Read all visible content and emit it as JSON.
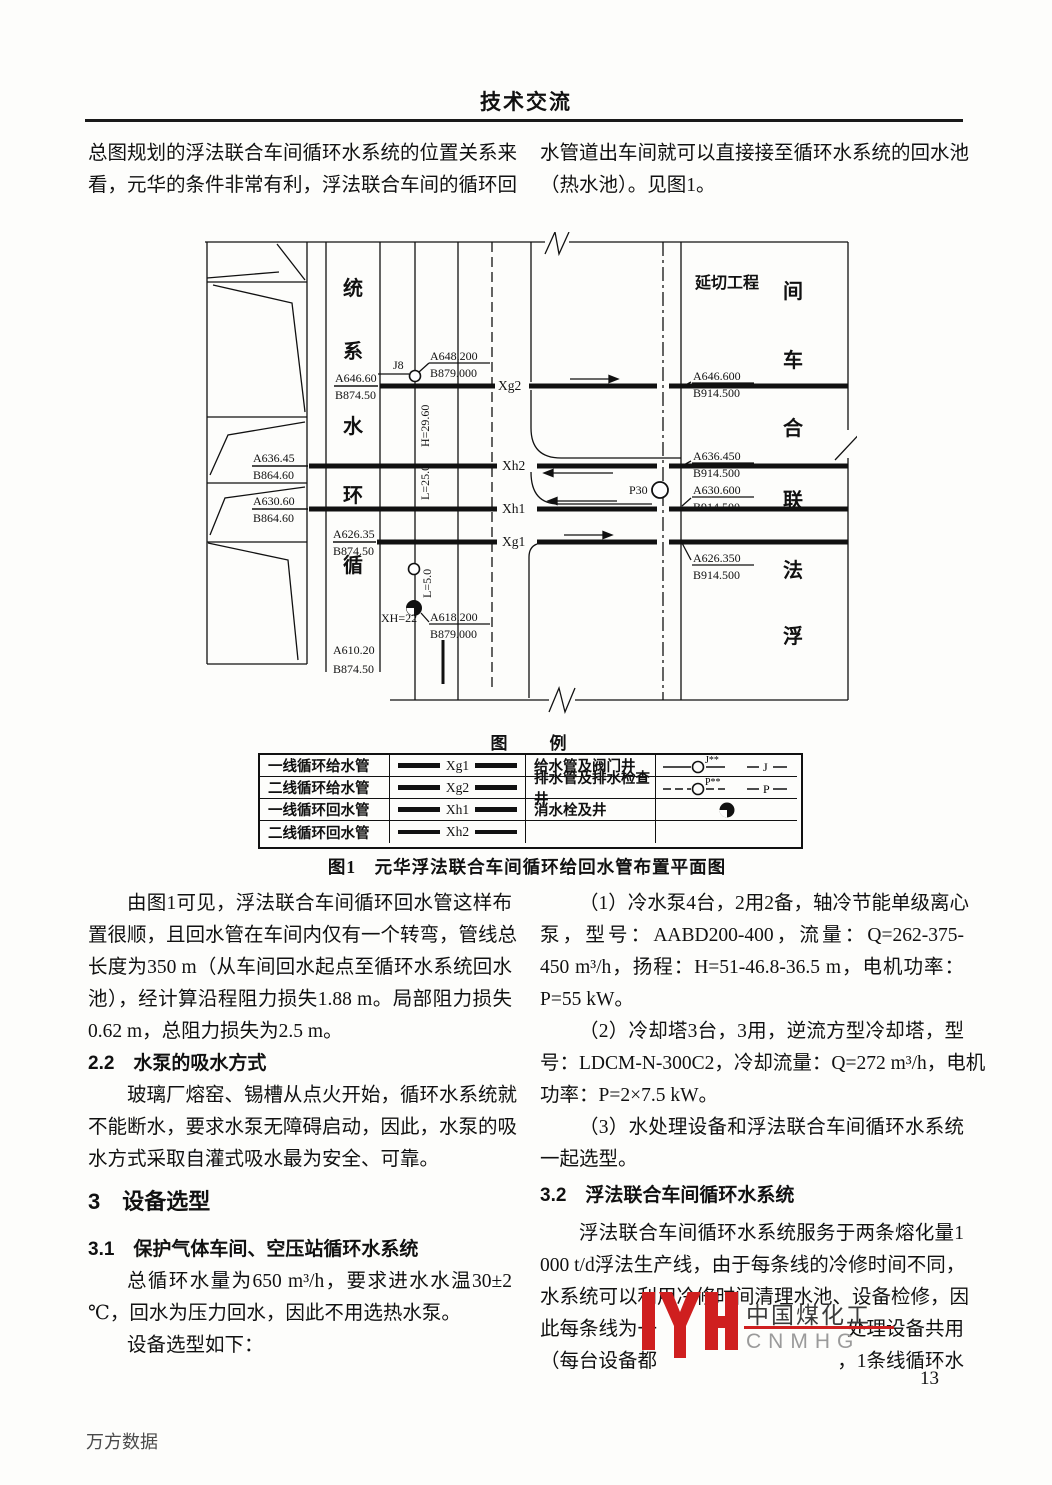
{
  "page": {
    "header": "技术交流",
    "page_number": "13",
    "footer": "万方数据"
  },
  "intro": {
    "left": [
      "总图规划的浮法联合车间循环水系统的位置关系来",
      "看，元华的条件非常有利，浮法联合车间的循环回"
    ],
    "right": [
      "水管道出车间就可以直接接至循环水系统的回水池",
      "（热水池）。见图1。"
    ]
  },
  "figure": {
    "caption": "图1　元华浮法联合车间循环给回水管布置平面图",
    "legend_title": {
      "t1": "图",
      "t2": "例"
    },
    "legend_rows": [
      {
        "name": "一线循环给水管",
        "pipe": "Xg1",
        "right": "给水管及阀门井",
        "sup": "J**",
        "sym": "J"
      },
      {
        "name": "二线循环给水管",
        "pipe": "Xg2",
        "right": "排水管及排水检查井",
        "sup": "P**",
        "sym": "P"
      },
      {
        "name": "一线循环回水管",
        "pipe": "Xh1",
        "right": "消水栓及井"
      },
      {
        "name": "二线循环回水管",
        "pipe": "Xh2",
        "right": ""
      }
    ],
    "diagram": {
      "zone_label": "延切工程",
      "left_axis_chars": [
        "统",
        "系",
        "水",
        "环",
        "循"
      ],
      "right_axis_chars": [
        "间",
        "车",
        "合",
        "联",
        "法",
        "浮"
      ],
      "pipes": {
        "xg2": "Xg2",
        "xh2": "Xh2",
        "xh1": "Xh1",
        "xg1": "Xg1"
      },
      "wells": {
        "j8": "J8",
        "p30": "P30"
      },
      "dims": {
        "h": "H=29.60",
        "l25": "L=25.0",
        "l5": "L=5.0",
        "xh22": "XH=22"
      },
      "elev": {
        "e1a": "A646.60",
        "e1b": "B874.50",
        "e2a": "A636.45",
        "e2b": "B864.60",
        "e3a": "A630.60",
        "e3b": "B864.60",
        "e4a": "A626.35",
        "e4b": "B874.50",
        "e5a": "A610.20",
        "e5b": "B874.50",
        "j8a": "A648.200",
        "j8b": "B879.000",
        "xha": "A618.200",
        "xhb": "B879.000",
        "r1a": "A646.600",
        "r1b": "B914.500",
        "r2a": "A636.450",
        "r2b": "B914.500",
        "r3a": "A630.600",
        "r3b": "B914.500",
        "r4a": "A626.350",
        "r4b": "B914.500"
      }
    }
  },
  "left_column": {
    "lines": [
      "由图1可见，浮法联合车间循环回水管这样布",
      "置很顺，且回水管在车间内仅有一个转弯，管线总",
      "长度为350 m（从车间回水起点至循环水系统回水",
      "池），经计算沿程阻力损失1.88 m。局部阻力损失",
      "0.62 m，总阻力损失为2.5 m。",
      "玻璃厂熔窑、锡槽从点火开始，循环水系统就",
      "不能断水，要求水泵无障碍启动，因此，水泵的吸",
      "水方式采取自灌式吸水最为安全、可靠。",
      "总循环水量为650 m³/h，要求进水水温30±2",
      "℃，回水为压力回水，因此不用选热水泵。",
      "设备选型如下："
    ],
    "heading_2_2": "2.2　水泵的吸水方式",
    "heading_3": "3　设备选型",
    "heading_3_1": "3.1　保护气体车间、空压站循环水系统"
  },
  "right_column": {
    "lines": [
      "（1）冷水泵4台，2用2备，轴冷节能单级离心",
      "泵，型号：AABD200-400，流量：Q=262-375-",
      "450 m³/h，扬程：H=51-46.8-36.5 m，电机功率：",
      "P=55 kW。",
      "（2）冷却塔3台，3用，逆流方型冷却塔，型",
      "号：LDCM-N-300C2，冷却流量：Q=272 m³/h，电机",
      "功率：P=2×7.5 kW。",
      "（3）水处理设备和浮法联合车间循环水系统",
      "一起选型。",
      "浮法联合车间循环水系统服务于两条熔化量1",
      "000 t/d浮法生产线，由于每条线的冷修时间不同，",
      "水系统可以利用冷修时间清理水池、设备检修，因"
    ],
    "heading_3_2": "3.2　浮法联合车间循环水系统",
    "line13_left": "此每条线为一",
    "line13_right": "处理设备共用",
    "line14_left": "（每台设备都",
    "line14_right": "，1条线循环水"
  },
  "watermark": {
    "line1": "中国煤化工",
    "line2": "CNMHG",
    "accent_color": "#cf1f1f"
  }
}
